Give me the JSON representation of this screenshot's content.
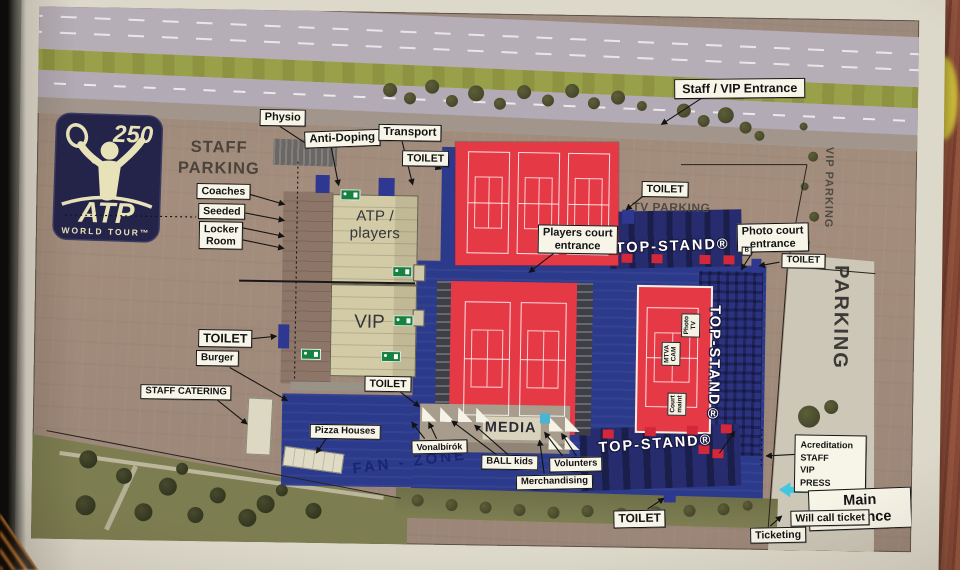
{
  "logo": {
    "tier": "250",
    "brand": "ATP",
    "tour": "WORLD TOUR™"
  },
  "zones": {
    "staff_parking": "STAFF\nPARKING",
    "tv_parking": "TV PARKING",
    "vip_parking": "VIP PARKING",
    "parking": "PARKING",
    "fan_zone": "FAN - ZONE",
    "atp_players": "ATP / players",
    "vip": "VIP",
    "media": "MEDIA",
    "top_stand_top": "TOP-STAND®",
    "top_stand_right": "TOP-STAND®",
    "top_stand_bottom": "TOP-STAND®",
    "stand_b": "B"
  },
  "court_labels": {
    "photo_tv": "Photo\nTV",
    "mtva_cam": "MTVA\nCAM",
    "court_maint": "Court\nmaint"
  },
  "callouts": {
    "staff_vip_entrance": "Staff / VIP Entrance",
    "physio": "Physio",
    "anti_doping": "Anti-Doping",
    "transport": "Transport",
    "toilet_top": "TOILET",
    "coaches": "Coaches",
    "seeded": "Seeded",
    "locker_room": "Locker\nRoom",
    "players_court_entrance": "Players court\nentrance",
    "toilet_court": "TOILET",
    "photo_court_entrance": "Photo court\nentrance",
    "toilet_right": "TOILET",
    "toilet_left": "TOILET",
    "burger": "Burger",
    "staff_catering": "STAFF CATERING",
    "pizza_houses": "Pizza Houses",
    "toilet_mid": "TOILET",
    "vonalbirok": "Vonalbírók",
    "ball_kids": "BALL kids",
    "volunters": "Volunters",
    "merchandising": "Merchandising",
    "toilet_bottom": "TOILET",
    "accreditation": "Acreditation\nSTAFF\nVIP\nPRESS",
    "main_entrance": "Main Entrance",
    "will_call": "Will call ticket",
    "ticketing": "Ticketing"
  },
  "colors": {
    "court_red": "#e63946",
    "plaza_blue": "#2c3a8c",
    "stand_navy": "#272c6e",
    "building_tan": "#d2cba6",
    "lot_brown": "#a08a7a",
    "exit_green": "#17813f",
    "arrow_cyan": "#3fc8e0",
    "label_bg": "#f7f4e8"
  }
}
